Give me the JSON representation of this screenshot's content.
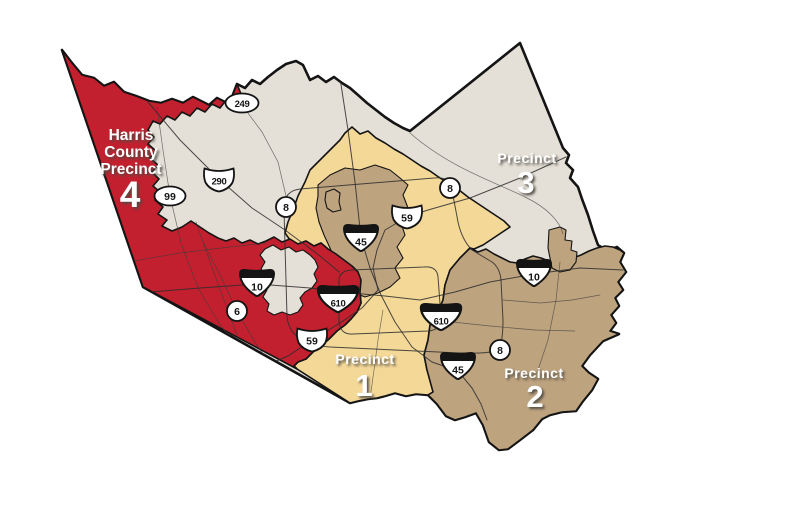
{
  "map": {
    "colors": {
      "precinct4_red": "#C2202E",
      "precinct3_gray": "#E4E0D7",
      "precinct1_yellow": "#F4D898",
      "precinct2_tan": "#BEA37F",
      "outline_black": "#141414",
      "background_white": "#FFFFFF"
    },
    "precinct4": {
      "line1": "Harris",
      "line2": "County",
      "line3": "Precinct",
      "number": "4"
    },
    "precinct3": {
      "label": "Precinct",
      "number": "3"
    },
    "precinct1": {
      "label": "Precinct",
      "number": "1"
    },
    "precinct2": {
      "label": "Precinct",
      "number": "2"
    },
    "shields": {
      "sh249": "249",
      "us290": "290",
      "sh99": "99",
      "loop8": "8",
      "us59": "59",
      "i45": "45",
      "i10": "10",
      "i610": "610",
      "sh6": "6"
    }
  }
}
